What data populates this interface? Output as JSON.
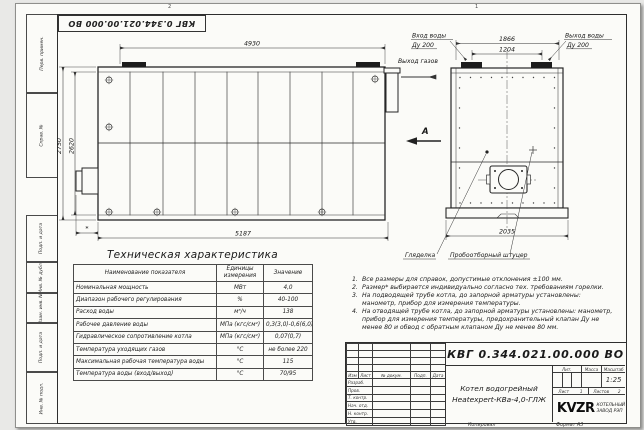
{
  "sheet": {
    "zone_labels": [
      "2",
      "1"
    ],
    "stamp_doc_number": "КВГ 0.344.021.00.000 ВО",
    "margin_labels": [
      "Перв. примен.",
      "Справ. №",
      "Подп. и дата",
      "Инв. № дубл.",
      "Взам. инв. №",
      "Подп. и дата",
      "Инв. № подл."
    ],
    "copied_label": "Копировал",
    "format_label": "Формат А3"
  },
  "drawing": {
    "main_view": {
      "dim_top": "4930",
      "dim_bottom": "5187",
      "dim_height_outer": "2750",
      "dim_height_inner": "2620",
      "dim_burner": "*",
      "gas_out_label": "Выход газов"
    },
    "front_view": {
      "dim_pipes_outer": "1866",
      "dim_pipes_centers": "1204",
      "dim_width": "2035",
      "water_in_label": "Вход воды",
      "water_in_dn": "Ду 200",
      "water_out_label": "Выход воды",
      "water_out_dn": "Ду 200",
      "view_mark": "А",
      "peephole_label": "Гляделка",
      "sampler_label": "Пробоотборный штуцер"
    }
  },
  "spec_table": {
    "title": "Техническая характеристика",
    "headers": [
      "Наименование показателя",
      "Единицы измерения",
      "Значение"
    ],
    "rows": [
      [
        "Номинальная мощность",
        "МВт",
        "4,0"
      ],
      [
        "Диапазон рабочего регулирования",
        "%",
        "40-100"
      ],
      [
        "Расход воды",
        "м³/ч",
        "138"
      ],
      [
        "Рабочее давление воды",
        "МПа (кгс/см²)",
        "0,3(3,0)-0,6(6,0)"
      ],
      [
        "Гидравлическое сопротивление котла",
        "МПа (кгс/см²)",
        "0,07(0,7)"
      ],
      [
        "Температура уходящих газов",
        "°С",
        "не более 220"
      ],
      [
        "Максимальная рабочая температура воды",
        "°С",
        "115"
      ],
      [
        "Температура воды (вход/выход)",
        "°С",
        "70/95"
      ]
    ]
  },
  "notes": [
    {
      "n": "1.",
      "text": "Все размеры для справок, допустимые отклонения ±100 мм."
    },
    {
      "n": "2.",
      "text": "Размер* выбирается индивидуально согласно тех. требованиям горелки."
    },
    {
      "n": "3.",
      "text": "На подводящей трубе котла, до запорной арматуры установлены: манометр, прибор для измерения температуры."
    },
    {
      "n": "4.",
      "text": "На отводящей трубе котла, до запорной арматуры установлены: манометр, прибор для измерения температуры, предохранительный клапан Ду не менее 80 и обвод с обратным клапаном Ду не менее 80 мм."
    }
  ],
  "title_block": {
    "doc_number": "КВГ 0.344.021.00.000 ВО",
    "product_line1": "Котел водогрейный",
    "product_line2": "Heatexpert-КВа-4,0-ГЛЖ",
    "change_headers": [
      "Изм",
      "Лист",
      "№ докум.",
      "Подп.",
      "Дата"
    ],
    "role_rows": [
      "Разраб.",
      "Пров.",
      "Т. контр.",
      "Нач. отд.",
      "Н. контр.",
      "Утв."
    ],
    "lit_label": "Лит.",
    "mass_label": "Масса",
    "scale_label": "Масштаб",
    "scale_value": "1:25",
    "sheet_label": "Лист",
    "sheet_value": "1",
    "sheets_label": "Листов",
    "sheets_value": "2",
    "brand": "KVZR",
    "brand_line1": "КОТЕЛЬНЫЙ",
    "brand_line2": "ЗАВОД РЭП"
  }
}
